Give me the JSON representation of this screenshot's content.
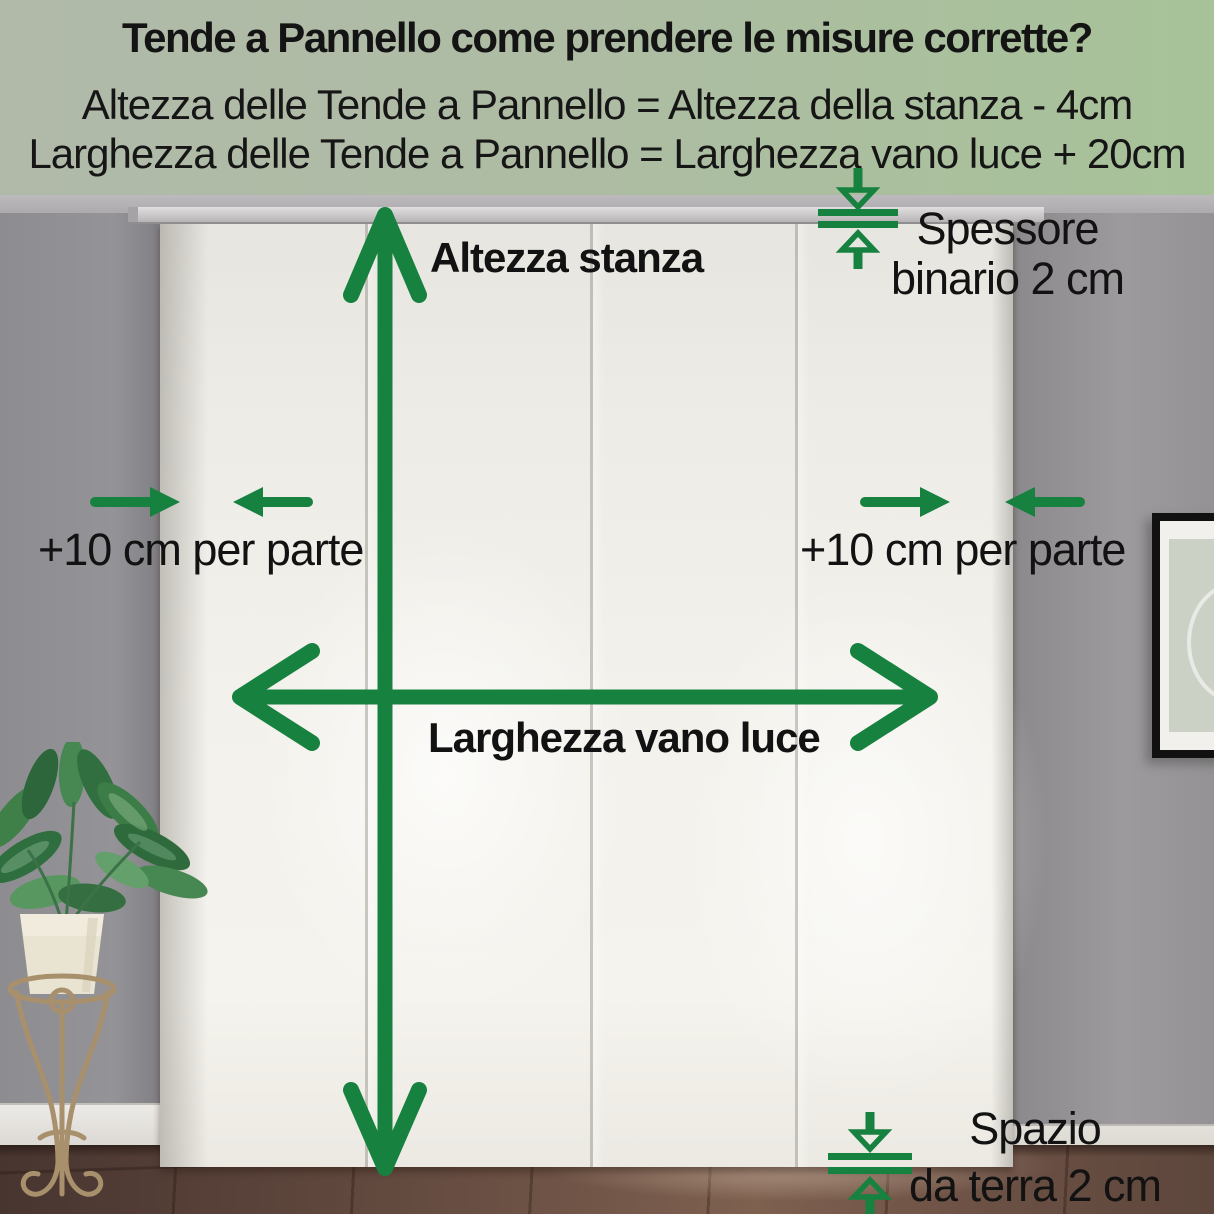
{
  "header": {
    "title": "Tende a Pannello come prendere le misure corrette?",
    "formula_height": "Altezza delle Tende a Pannello = Altezza della stanza - 4cm",
    "formula_width": "Larghezza delle Tende a Pannello = Larghezza vano luce + 20cm"
  },
  "annotations": {
    "room_height": "Altezza stanza",
    "opening_width": "Larghezza vano luce",
    "side_allowance_left": "+10 cm per parte",
    "side_allowance_right": "+10 cm per parte",
    "track_thickness": {
      "line1": "Spessore",
      "line2": "binario 2 cm"
    },
    "floor_gap": {
      "line1": "Spazio",
      "line2": "da terra 2 cm"
    }
  },
  "icons": {
    "room_height_arrow": "double-headed-vertical-arrow",
    "opening_width_arrow": "double-headed-horizontal-arrow",
    "side_allowance_arrows": "inward-pointing-arrows",
    "track_thickness_indicator": "gap-caliper-arrows",
    "floor_gap_indicator": "gap-caliper-arrows"
  },
  "colors": {
    "accent_green": "#17813F",
    "header_bg_left": "#B1BAA9",
    "header_bg_right": "#A7C299",
    "text": "#131313"
  }
}
